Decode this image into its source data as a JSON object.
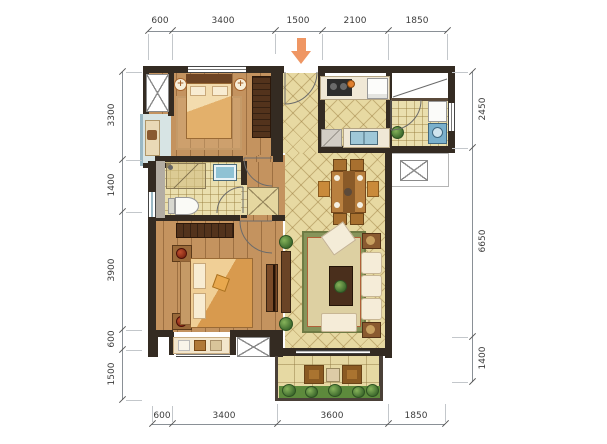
{
  "drawing": {
    "kind": "apartment floor plan"
  },
  "dimensions": {
    "top": [
      "600",
      "3400",
      "1500",
      "2100",
      "1850"
    ],
    "bottom": [
      "600",
      "3400",
      "3600",
      "1850"
    ],
    "left": [
      "3300",
      "1400",
      "3900",
      "600",
      "1500"
    ],
    "right": [
      "2450",
      "6650",
      "1400"
    ]
  },
  "icons": {
    "entrance_arrow": "entrance-arrow-icon",
    "ac_platform": "ac-platform-x-icon",
    "lamp_plus": "+"
  },
  "colors": {
    "accent_arrow": "#EF9663",
    "wall": "#342B22",
    "wood_floor": "#C4935F",
    "tile_floor": "#E7D9A2",
    "bath_tile": "#EADFAE",
    "water_blue": "#8FC2D4",
    "sofa_cream": "#F5ECD8",
    "plant_green": "#55803A",
    "rug_border": "#87945A",
    "dim_text": "#3C3C3C"
  }
}
